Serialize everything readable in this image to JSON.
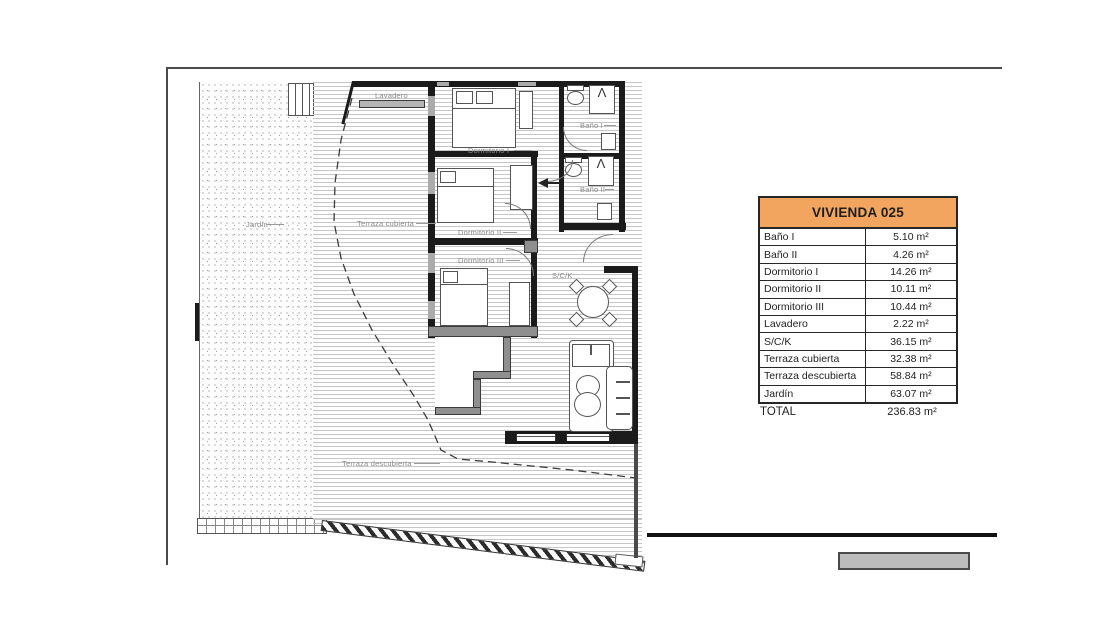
{
  "plan": {
    "labels": {
      "lavadero": "Lavadero",
      "dormitorio1": "Dormitorio I",
      "dormitorio2": "Dormitorio II",
      "dormitorio3": "Dormitorio III",
      "bano1": "Baño I",
      "bano2": "Baño II",
      "sck": "S/C/K",
      "terraza_cubierta": "Terraza cubierta",
      "terraza_descubierta": "Terraza descubierta",
      "jardin": "Jardín"
    },
    "icons": {
      "shower_glyph": "Λ"
    }
  },
  "table": {
    "title": "VIVIENDA 025",
    "header_bg": "#F2A55F",
    "rows": [
      {
        "label": "Baño I",
        "value": "5.10 m²"
      },
      {
        "label": "Baño II",
        "value": "4.26 m²"
      },
      {
        "label": "Dormitorio I",
        "value": "14.26 m²"
      },
      {
        "label": "Dormitorio II",
        "value": "10.11 m²"
      },
      {
        "label": "Dormitorio III",
        "value": "10.44 m²"
      },
      {
        "label": "Lavadero",
        "value": "2.22 m²"
      },
      {
        "label": "S/C/K",
        "value": "36.15 m²"
      },
      {
        "label": "Terraza cubierta",
        "value": "32.38 m²"
      },
      {
        "label": "Terraza descubierta",
        "value": "58.84 m²"
      },
      {
        "label": "Jardín",
        "value": "63.07 m²"
      }
    ],
    "total": {
      "label": "TOTAL",
      "value": "236.83 m²"
    }
  }
}
